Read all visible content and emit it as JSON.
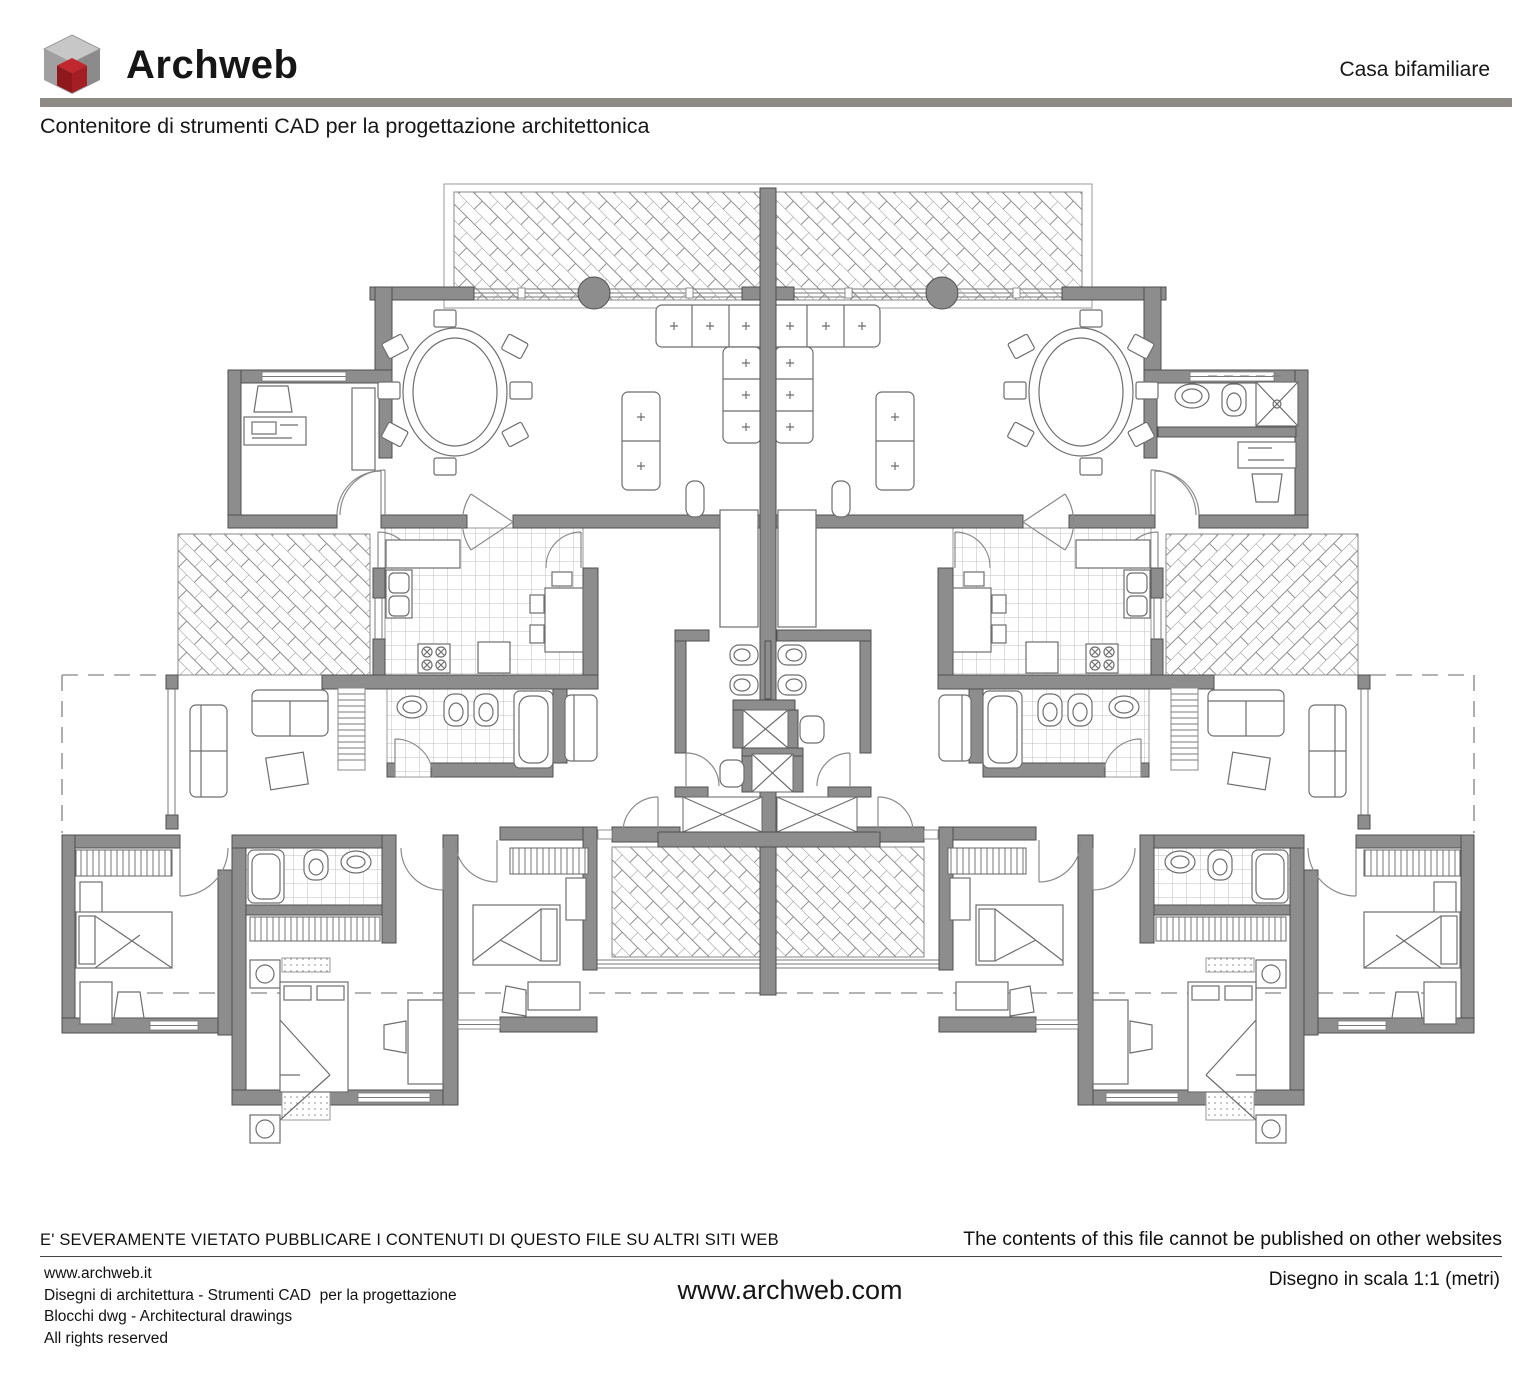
{
  "header": {
    "brand": "Archweb",
    "project_title": "Casa bifamiliare",
    "tagline": "Contenitore di strumenti CAD per la progettazione architettonica"
  },
  "drawing": {
    "type": "architectural-floor-plan",
    "subject": "Casa bifamiliare (two-family house), symmetric duplex plan",
    "colors": {
      "wall_gray": "#8d8d8d",
      "bar_gray": "#8e8a85",
      "logo_red": "#9e1b20"
    }
  },
  "footer": {
    "warning_it": "E' SEVERAMENTE VIETATO PUBBLICARE I CONTENUTI DI QUESTO FILE SU ALTRI SITI WEB",
    "warning_en": "The contents of this file cannot be published on other websites",
    "site": "www.archweb.it",
    "line2": "Disegni di architettura - Strumenti CAD  per la progettazione",
    "line3": "Blocchi dwg - Architectural drawings",
    "line4": "All rights reserved",
    "url": "www.archweb.com",
    "scale_note": "Disegno in scala 1:1 (metri)"
  }
}
